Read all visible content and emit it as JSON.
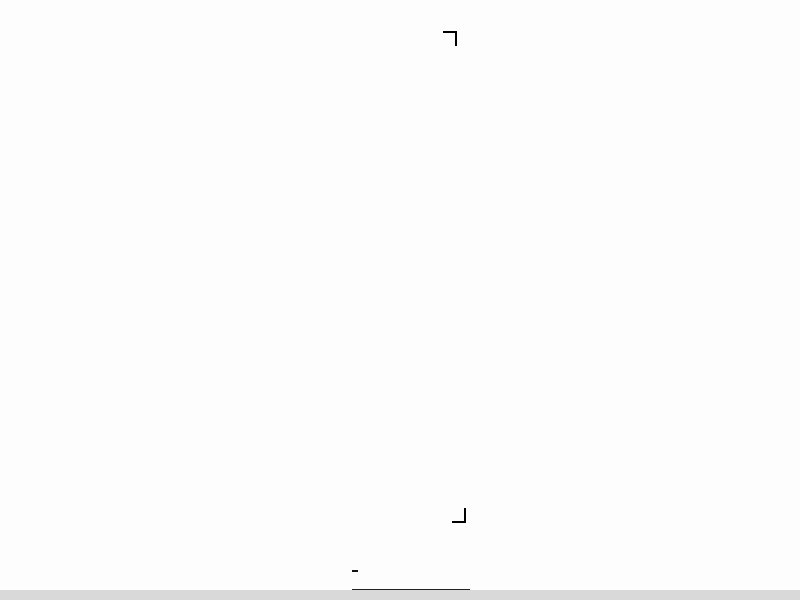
{
  "meta": {
    "drawing_title": "一层平面图",
    "drawing_scale": "1:100"
  },
  "watermark": {
    "text": "济南腾昊",
    "color": "#e2383f"
  },
  "grid": {
    "top": {
      "labels": [
        "1",
        "3",
        "5",
        "6",
        "7",
        "9"
      ],
      "x": [
        123,
        247,
        371,
        433,
        495,
        617
      ],
      "y": 27
    },
    "bottom": {
      "labels": [
        "1",
        "3",
        "5",
        "6",
        "7",
        "9"
      ],
      "x": [
        123,
        247,
        371,
        433,
        495,
        617
      ],
      "y": 511
    },
    "left": {
      "labels": [
        "D",
        "C",
        "B",
        "A"
      ],
      "y": [
        157,
        271,
        306,
        424
      ],
      "x": 37
    },
    "right": {
      "labels": [
        "D",
        "C",
        "B",
        "A"
      ],
      "y": [
        157,
        271,
        306,
        424
      ],
      "x": 760
    }
  },
  "dimensions": {
    "top_total": "32400",
    "top_bays": [
      "120",
      "3600",
      "3600",
      "3600",
      "3600",
      "3600",
      "3600",
      "3600",
      "3600",
      "3600"
    ],
    "top_sub_bay": [
      "1050",
      "1500",
      "1050"
    ],
    "top_sub_repeat": 9,
    "bottom_detail": [
      "3600",
      "1050",
      "1500",
      "1050",
      "1050",
      "1500",
      "1050",
      "1050",
      "1500",
      "1050",
      "1050",
      "1500",
      "1050",
      "1200",
      "1200",
      "1200",
      "1050",
      "1500",
      "1050",
      "1050",
      "1500",
      "1050",
      "3600"
    ],
    "bottom_bays": [
      "120",
      "3600",
      "3600",
      "3600",
      "3600",
      "3600",
      "3600",
      "3600",
      "3600",
      "3600"
    ],
    "bottom_total": "32400",
    "left_main": [
      "120",
      "6600",
      "2100",
      "6600",
      "120"
    ],
    "left_sub": [
      "450",
      "1200",
      "450"
    ],
    "left_total": "15300",
    "right_main": [
      "120",
      "6600",
      "2100",
      "6600",
      "120"
    ],
    "right_total": "15300",
    "vestibule": {
      "depth": "1200",
      "left": "300",
      "right": "300"
    }
  },
  "section_marks": {
    "top": "1",
    "bottom": "1"
  },
  "rooms": [
    {
      "name": "培养室一",
      "x": 168,
      "y": 257,
      "cls": "room"
    },
    {
      "name": "接种室",
      "x": 256,
      "y": 178,
      "cls": "room small"
    },
    {
      "name": "冷凝室",
      "x": 348,
      "y": 180,
      "cls": "room"
    },
    {
      "name": "配药灭菌室",
      "x": 366,
      "y": 234,
      "cls": "room small"
    },
    {
      "name": "苹果病毒",
      "x": 548,
      "y": 181,
      "cls": "room small"
    },
    {
      "name": "检测室",
      "x": 551,
      "y": 195,
      "cls": "room small"
    },
    {
      "name": "洁净走廊",
      "x": 196,
      "y": 283,
      "cls": "room"
    },
    {
      "name": "培养室二",
      "x": 162,
      "y": 312,
      "cls": "room"
    },
    {
      "name": "男更衣室",
      "x": 262,
      "y": 326,
      "cls": "room small"
    },
    {
      "name": "女更衣室",
      "x": 310,
      "y": 347,
      "cls": "room small"
    },
    {
      "name": "洗涤晾晒室",
      "x": 354,
      "y": 350,
      "cls": "room small"
    },
    {
      "name": "苹果脱毒室",
      "x": 576,
      "y": 357,
      "cls": "room"
    }
  ],
  "equipment": [
    {
      "name": "超净台",
      "x": 487,
      "y": 235
    },
    {
      "name": "通风柜",
      "x": 549,
      "y": 248
    },
    {
      "name": "灭菌锅",
      "x": 356,
      "y": 216
    },
    {
      "name": "储藏架",
      "x": 387,
      "y": 200
    },
    {
      "name": "储藏柜",
      "x": 404,
      "y": 226
    },
    {
      "name": "冰箱",
      "x": 325,
      "y": 250
    },
    {
      "name": "边台试验台",
      "x": 338,
      "y": 259
    },
    {
      "name": "传递窗",
      "x": 313,
      "y": 204
    },
    {
      "name": "风淋",
      "x": 250,
      "y": 328,
      "vertical": true
    },
    {
      "name": "手消毒",
      "x": 249,
      "y": 386,
      "vertical": true
    },
    {
      "name": "洗衣机",
      "x": 400,
      "y": 333
    },
    {
      "name": "纯水机",
      "x": 398,
      "y": 410
    }
  ]
}
